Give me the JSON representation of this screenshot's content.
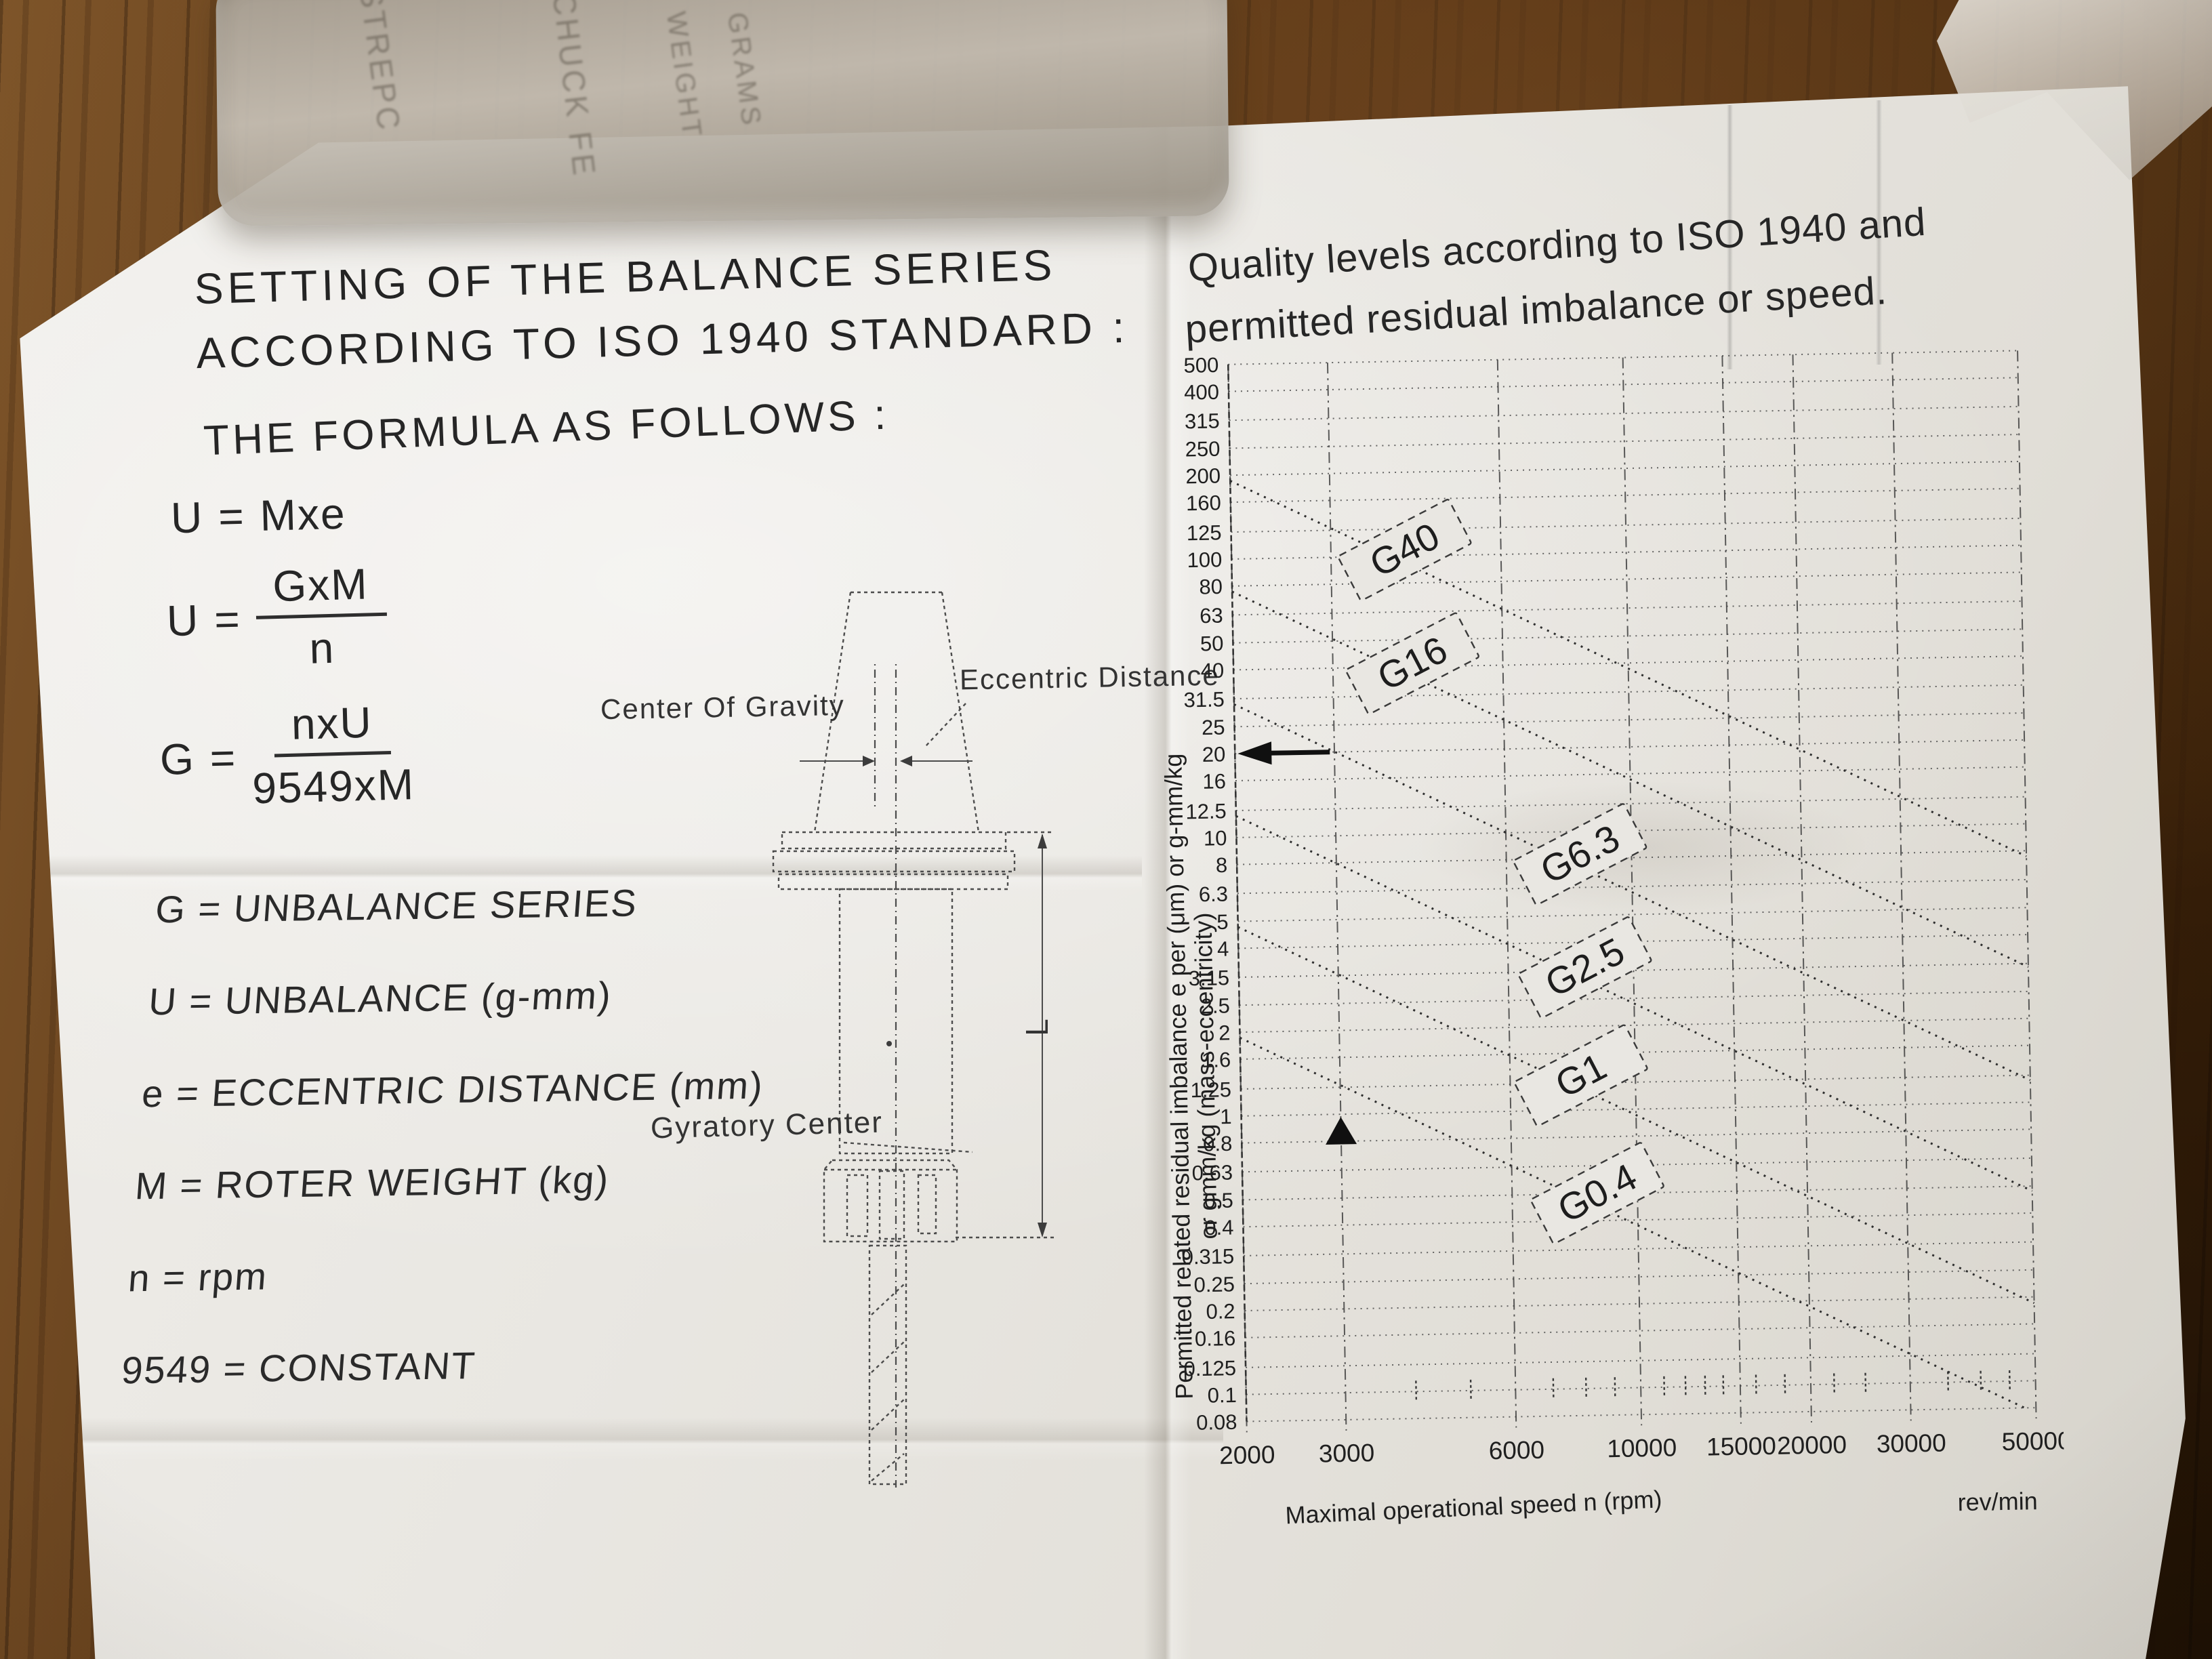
{
  "left_page": {
    "title_line1": "SETTING OF THE BALANCE SERIES",
    "title_line2": "ACCORDING TO ISO 1940 STANDARD :",
    "formula_heading": "THE FORMULA AS FOLLOWS :",
    "formulas": {
      "f1": {
        "lhs": "U",
        "eq": "=",
        "rhs": "Mxe"
      },
      "f2": {
        "lhs": "U",
        "eq": "=",
        "numerator": "GxM",
        "denominator": "n"
      },
      "f3": {
        "lhs": "G",
        "eq": "=",
        "numerator": "nxU",
        "denominator": "9549xM"
      }
    },
    "definitions": [
      "G = UNBALANCE SERIES",
      "U = UNBALANCE (g-mm)",
      "e = ECCENTRIC DISTANCE (mm)",
      "M = ROTER WEIGHT (kg)",
      "n = rpm",
      "9549 = CONSTANT"
    ],
    "diagram": {
      "label_center_of_gravity": "Center Of Gravity",
      "label_eccentric_distance": "Eccentric Distance",
      "label_gyratory_center": "Gyratory Center",
      "label_length": "L"
    }
  },
  "right_page": {
    "title_line1": "Quality levels according to ISO 1940 and",
    "title_line2": "permitted residual imbalance or speed.",
    "chart_data": {
      "type": "line",
      "relation": "e = 9549 x G / n",
      "x_axis": {
        "label": "Maximal operational speed n (rpm)",
        "unit_label": "rev/min",
        "scale": "log",
        "range": [
          2000,
          50000
        ],
        "ticks": [
          2000,
          3000,
          6000,
          10000,
          15000,
          20000,
          30000,
          50000
        ]
      },
      "y_axis": {
        "label_line1": "Permitted related residual imbalance e per (μm) or g-mm/kg",
        "label_line2": "or gmm/kg (mass-eccentricity)",
        "scale": "log",
        "range": [
          0.08,
          500
        ],
        "ticks": [
          500,
          400,
          315,
          250,
          200,
          160,
          125,
          100,
          80,
          63,
          50,
          40,
          31.5,
          25,
          20,
          16,
          12.5,
          10,
          8,
          6.3,
          5,
          4,
          3.15,
          2.5,
          2,
          1.6,
          1.25,
          1,
          0.8,
          0.63,
          0.5,
          0.4,
          0.315,
          0.25,
          0.2,
          0.16,
          0.125,
          0.1,
          0.08
        ]
      },
      "minor_ticks_x": [
        4000,
        5000,
        7000,
        8000,
        9000,
        11000,
        12000,
        13000,
        14000,
        16000,
        18000,
        22000,
        25000,
        35000,
        40000,
        45000
      ],
      "series": [
        {
          "name": "G40",
          "G": 40,
          "label_n": 4200,
          "points": [
            [
              2000,
              190.98
            ],
            [
              50000,
              7.64
            ]
          ]
        },
        {
          "name": "G16",
          "G": 16,
          "label_n": 4300,
          "points": [
            [
              2000,
              76.39
            ],
            [
              50000,
              3.06
            ]
          ]
        },
        {
          "name": "G6.3",
          "G": 6.3,
          "label_n": 8400,
          "points": [
            [
              2000,
              30.08
            ],
            [
              50000,
              1.2
            ]
          ]
        },
        {
          "name": "G2.5",
          "G": 2.5,
          "label_n": 8500,
          "points": [
            [
              2000,
              11.94
            ],
            [
              50000,
              0.48
            ]
          ]
        },
        {
          "name": "G1",
          "G": 1,
          "label_n": 8300,
          "points": [
            [
              2000,
              4.77
            ],
            [
              50000,
              0.19
            ]
          ]
        },
        {
          "name": "G0.4",
          "G": 0.4,
          "label_n": 8800,
          "points": [
            [
              2000,
              1.91
            ],
            [
              47745,
              0.08
            ]
          ]
        }
      ],
      "annotations": [
        {
          "type": "arrow-left",
          "at_y": 20
        },
        {
          "type": "arrow-up",
          "at_x": 3000,
          "between_y": [
            0.78,
            1.0
          ]
        }
      ]
    }
  },
  "plastic_container": {
    "faint_labels": [
      "STREPC",
      "CHUCK FE",
      "WEIGHT",
      "GRAMS"
    ]
  }
}
